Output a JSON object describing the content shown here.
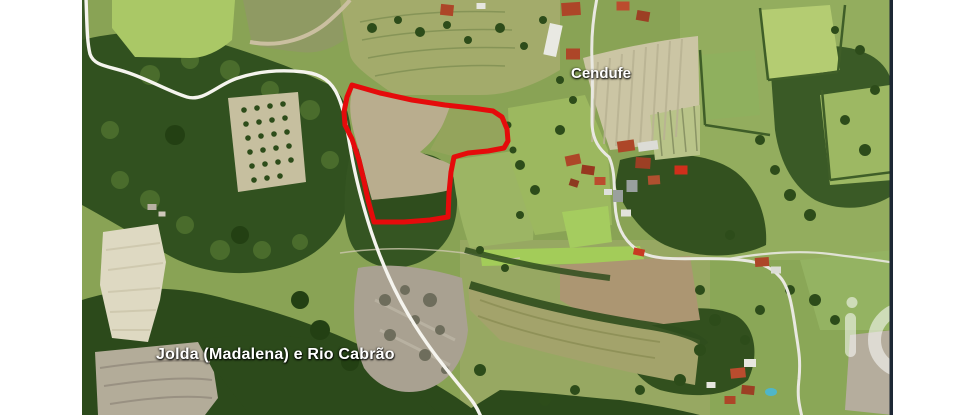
{
  "map": {
    "place_labels": [
      {
        "text": "Cendufe"
      },
      {
        "text": "Jolda (Madalena) e Rio Cabrão"
      }
    ],
    "parcel_boundary": {
      "color": "#e50b0b",
      "points": "352,85 380,93 412,100 445,105 472,108 493,111 502,117 507,129 508,141 504,148 488,151 468,153 454,157 451,172 449,193 448,217 430,220 404,222 374,222 368,200 364,181 359,160 352,139 345,125 344,112 347,97"
    },
    "roads": {
      "road_color": "#f5f4ee",
      "west_road_path": "M 86,-2 C 87,25 87,42 90,54 C 94,66 108,66 126,72 C 148,79 170,92 187,97 C 204,102 218,84 238,78 C 262,70 286,70 304,72 C 322,74 332,82 338,96 C 345,112 347,130 351,152 C 356,180 363,206 371,231 C 380,258 392,287 408,314 C 425,343 442,364 464,391 C 472,400 477,407 481,417",
      "east_road_path": "M 597,-2 C 593,18 591,38 592,60 C 593,82 592,102 592,122 C 592,140 600,150 609,157 C 615,170 614,185 615,204 C 616,224 622,240 639,251 C 658,263 692,257 728,259 C 750,260 768,263 780,277 C 789,287 792,306 795,326 C 798,348 801,357 799,379 C 797,396 799,404 802,417",
      "east_spur_path": "M 728,259 C 762,253 800,250 830,254 C 852,257 872,259 895,263"
    },
    "watermark": {
      "strip_color": "#1d2734",
      "glyph_name": "i-ring-logo-watermark"
    }
  }
}
